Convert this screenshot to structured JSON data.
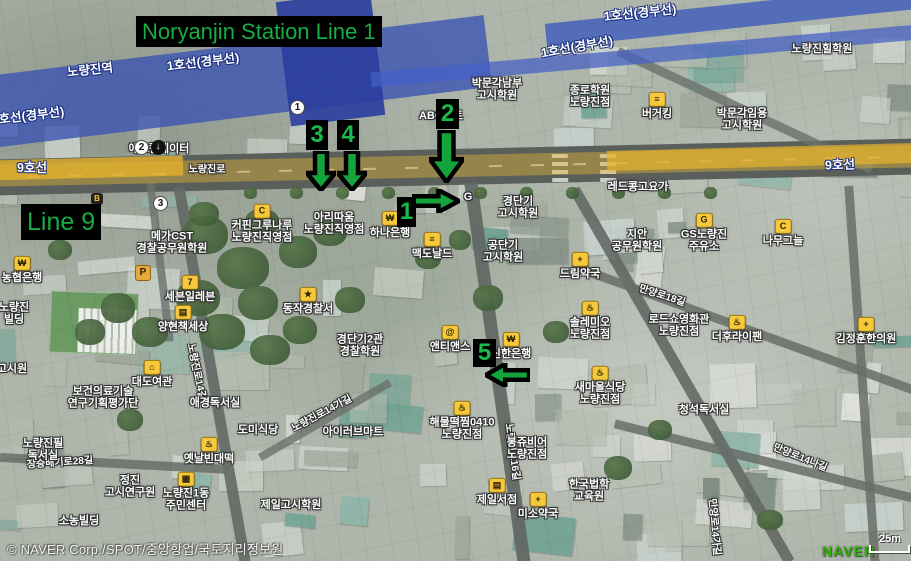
{
  "overlays": {
    "title": "Noryanjin Station Line 1",
    "line9_label": "Line 9",
    "accent_green": "#15ae44",
    "markers": [
      {
        "num": "1",
        "dir": "right",
        "box": {
          "x": 397,
          "y": 197,
          "w": 19,
          "h": 30
        },
        "arrow": {
          "x": 412,
          "y": 189,
          "w": 48,
          "h": 24
        }
      },
      {
        "num": "2",
        "dir": "down",
        "box": {
          "x": 436,
          "y": 99,
          "w": 23,
          "h": 30
        },
        "arrow": {
          "x": 429,
          "y": 130,
          "w": 35,
          "h": 53
        }
      },
      {
        "num": "3",
        "dir": "down",
        "box": {
          "x": 306,
          "y": 120,
          "w": 22,
          "h": 30
        },
        "arrow": {
          "x": 306,
          "y": 151,
          "w": 30,
          "h": 40
        }
      },
      {
        "num": "4",
        "dir": "down",
        "box": {
          "x": 337,
          "y": 120,
          "w": 22,
          "h": 30
        },
        "arrow": {
          "x": 337,
          "y": 151,
          "w": 30,
          "h": 40
        }
      },
      {
        "num": "5",
        "dir": "left",
        "box": {
          "x": 473,
          "y": 339,
          "w": 23,
          "h": 28
        },
        "arrow": {
          "x": 485,
          "y": 363,
          "w": 45,
          "h": 24
        }
      }
    ]
  },
  "map": {
    "transit_labels": [
      {
        "text": "노량진역",
        "x": 90,
        "y": 70,
        "rot": -6
      },
      {
        "text": "1호선(경부선)",
        "x": 203,
        "y": 62,
        "rot": -7
      },
      {
        "text": "1호선(경부선)",
        "x": 28,
        "y": 116,
        "rot": -7
      },
      {
        "text": "1호선(경부선)",
        "x": 577,
        "y": 47,
        "rot": -10
      },
      {
        "text": "1호선(경부선)",
        "x": 640,
        "y": 13,
        "rot": -6
      },
      {
        "text": "9호선",
        "x": 32,
        "y": 168,
        "rot": 0
      },
      {
        "text": "9호선",
        "x": 840,
        "y": 165,
        "rot": -2
      }
    ],
    "road_labels": [
      {
        "text": "노량진로",
        "x": 207,
        "y": 170,
        "rot": 0
      },
      {
        "text": "노량진로14길",
        "x": 196,
        "y": 372,
        "rot": 78
      },
      {
        "text": "노량진로14가길",
        "x": 322,
        "y": 414,
        "rot": -28
      },
      {
        "text": "노량진로16길",
        "x": 512,
        "y": 452,
        "rot": 82
      },
      {
        "text": "만양로18길",
        "x": 662,
        "y": 296,
        "rot": 18
      },
      {
        "text": "만양로14나길",
        "x": 800,
        "y": 458,
        "rot": 22
      },
      {
        "text": "만양로14가길",
        "x": 714,
        "y": 527,
        "rot": 85
      },
      {
        "text": "장승배기로28길",
        "x": 60,
        "y": 463,
        "rot": -4
      }
    ],
    "poi_labels": [
      {
        "lines": [
          "박문각남부",
          "고시학원"
        ],
        "x": 497,
        "y": 90
      },
      {
        "lines": [
          "종로학원",
          "노량진점"
        ],
        "x": 590,
        "y": 97
      },
      {
        "lines": [
          "버거킹"
        ],
        "x": 657,
        "y": 106,
        "icon": "burger"
      },
      {
        "lines": [
          "박문각임용",
          "고시학원"
        ],
        "x": 742,
        "y": 120
      },
      {
        "lines": [
          "노량진힐학원"
        ],
        "x": 822,
        "y": 49
      },
      {
        "lines": [
          "ABC마트"
        ],
        "x": 441,
        "y": 116
      },
      {
        "lines": [
          "에스컬레이터"
        ],
        "x": 159,
        "y": 149
      },
      {
        "lines": [
          "메가CST",
          "경찰공무원학원"
        ],
        "x": 172,
        "y": 243
      },
      {
        "lines": [
          "커핀그루나루",
          "노량진직영점"
        ],
        "x": 262,
        "y": 224,
        "icon": "coffee"
      },
      {
        "lines": [
          "아리따움",
          "노량진직영점"
        ],
        "x": 334,
        "y": 224
      },
      {
        "lines": [
          "하나은행"
        ],
        "x": 390,
        "y": 225,
        "icon": "bank"
      },
      {
        "lines": [
          "맥도날드"
        ],
        "x": 432,
        "y": 246,
        "icon": "burger"
      },
      {
        "lines": [
          "농협은행"
        ],
        "x": 22,
        "y": 270,
        "icon": "bank"
      },
      {
        "lines": [
          "노량진",
          "빌딩"
        ],
        "x": 14,
        "y": 314
      },
      {
        "lines": [
          "세븐일레븐"
        ],
        "x": 190,
        "y": 289,
        "icon": "bag"
      },
      {
        "lines": [
          "양현책세상"
        ],
        "x": 183,
        "y": 319,
        "icon": "book"
      },
      {
        "lines": [
          "동작경찰서"
        ],
        "x": 308,
        "y": 301,
        "icon": "police"
      },
      {
        "lines": [
          "경단기",
          "고시학원"
        ],
        "x": 518,
        "y": 208
      },
      {
        "lines": [
          "공단기",
          "고시학원"
        ],
        "x": 503,
        "y": 252
      },
      {
        "lines": [
          "레드콩고요가"
        ],
        "x": 638,
        "y": 187
      },
      {
        "lines": [
          "지안",
          "공무원학원"
        ],
        "x": 637,
        "y": 241
      },
      {
        "lines": [
          "드림약국"
        ],
        "x": 580,
        "y": 266,
        "icon": "pharmacy"
      },
      {
        "lines": [
          "GS노량진",
          "주유소"
        ],
        "x": 704,
        "y": 233,
        "icon": "gas"
      },
      {
        "lines": [
          "나무그늘"
        ],
        "x": 783,
        "y": 233,
        "icon": "coffee"
      },
      {
        "lines": [
          "김정훈한의원"
        ],
        "x": 866,
        "y": 331,
        "icon": "clinic"
      },
      {
        "lines": [
          "솔레미오",
          "노량진점"
        ],
        "x": 590,
        "y": 321,
        "icon": "food"
      },
      {
        "lines": [
          "로드쇼영화관",
          "노량진점"
        ],
        "x": 679,
        "y": 326
      },
      {
        "lines": [
          "더후라이팬"
        ],
        "x": 737,
        "y": 329,
        "icon": "food"
      },
      {
        "lines": [
          "새마을식당",
          "노량진점"
        ],
        "x": 600,
        "y": 386,
        "icon": "food"
      },
      {
        "lines": [
          "청석독서실"
        ],
        "x": 704,
        "y": 410
      },
      {
        "lines": [
          "앤티앤스"
        ],
        "x": 450,
        "y": 339,
        "icon": "pretzel"
      },
      {
        "lines": [
          "경단기2관",
          "경찰학원"
        ],
        "x": 360,
        "y": 346
      },
      {
        "lines": [
          "신한은행"
        ],
        "x": 511,
        "y": 346,
        "icon": "bank"
      },
      {
        "lines": [
          "해물떡찜0410",
          "노량진점"
        ],
        "x": 462,
        "y": 421,
        "icon": "food"
      },
      {
        "lines": [
          "봉쥬비어",
          "노량진점"
        ],
        "x": 527,
        "y": 449
      },
      {
        "lines": [
          "제일서점"
        ],
        "x": 497,
        "y": 492,
        "icon": "book"
      },
      {
        "lines": [
          "미소약국"
        ],
        "x": 538,
        "y": 506,
        "icon": "pharmacy"
      },
      {
        "lines": [
          "한국법학",
          "교육원"
        ],
        "x": 589,
        "y": 491
      },
      {
        "lines": [
          "대도여관"
        ],
        "x": 152,
        "y": 374,
        "icon": "hotel"
      },
      {
        "lines": [
          "보건의료기술",
          "연구기획평가단"
        ],
        "x": 103,
        "y": 398
      },
      {
        "lines": [
          "애경독서실"
        ],
        "x": 215,
        "y": 403
      },
      {
        "lines": [
          "노량진필",
          "독서실"
        ],
        "x": 43,
        "y": 450
      },
      {
        "lines": [
          "옛날빈대떡"
        ],
        "x": 209,
        "y": 451,
        "icon": "food"
      },
      {
        "lines": [
          "도미식당"
        ],
        "x": 258,
        "y": 430
      },
      {
        "lines": [
          "아이러브마트"
        ],
        "x": 353,
        "y": 432
      },
      {
        "lines": [
          "정진",
          "고시연구원"
        ],
        "x": 130,
        "y": 487
      },
      {
        "lines": [
          "노량진1동",
          "주민센터"
        ],
        "x": 186,
        "y": 492,
        "icon": "office"
      },
      {
        "lines": [
          "제일고시학원"
        ],
        "x": 291,
        "y": 505
      },
      {
        "lines": [
          "소농빌딩"
        ],
        "x": 79,
        "y": 521
      },
      {
        "lines": [
          "고시원"
        ],
        "x": 12,
        "y": 369
      },
      {
        "lines": [
          "G"
        ],
        "x": 468,
        "y": 197
      }
    ],
    "exit_badges": [
      {
        "num": "1",
        "x": 297,
        "y": 107
      },
      {
        "num": "2",
        "x": 141,
        "y": 147
      },
      {
        "num": "3",
        "x": 160,
        "y": 203
      }
    ],
    "misc_icons": [
      {
        "kind": "parking",
        "x": 142,
        "y": 272
      },
      {
        "kind": "escalator",
        "x": 158,
        "y": 147
      },
      {
        "kind": "bus-stop",
        "x": 97,
        "y": 199
      }
    ],
    "icon_color": "#f6c83b"
  },
  "footer": {
    "attribution": "© NAVER Corp./SPOT/중앙항업/국토지리정보원",
    "logo": "NAVER",
    "logo_color": "#2db400",
    "scale": "25m"
  }
}
